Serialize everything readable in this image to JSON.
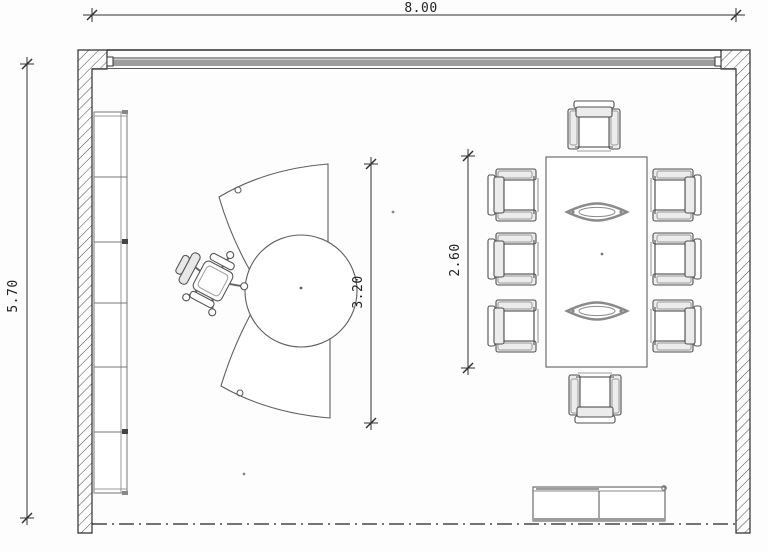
{
  "drawing": {
    "kind": "meeting-room-floor-plan",
    "dimensions": {
      "room_width": "8.00",
      "room_depth": "5.70",
      "desk_span": "3.20",
      "table_length": "2.60"
    },
    "symbols": {
      "shelf": "wall-shelf-unit",
      "desk": "curved-executive-desk-with-round-extension",
      "desk_chair": "swivel-office-chair",
      "table": "conference-table",
      "chairs": "eight-conference-armchairs",
      "sideboard": "low-sideboard",
      "window": "glazed-facade-band",
      "centerline": "dash-dot-boundary-line"
    },
    "colors": {
      "wall_line": "#2e2e2e",
      "furniture_line": "#5f5f5f",
      "gray_fill": "#9c9c9c",
      "background": "#fdfdfd"
    }
  }
}
